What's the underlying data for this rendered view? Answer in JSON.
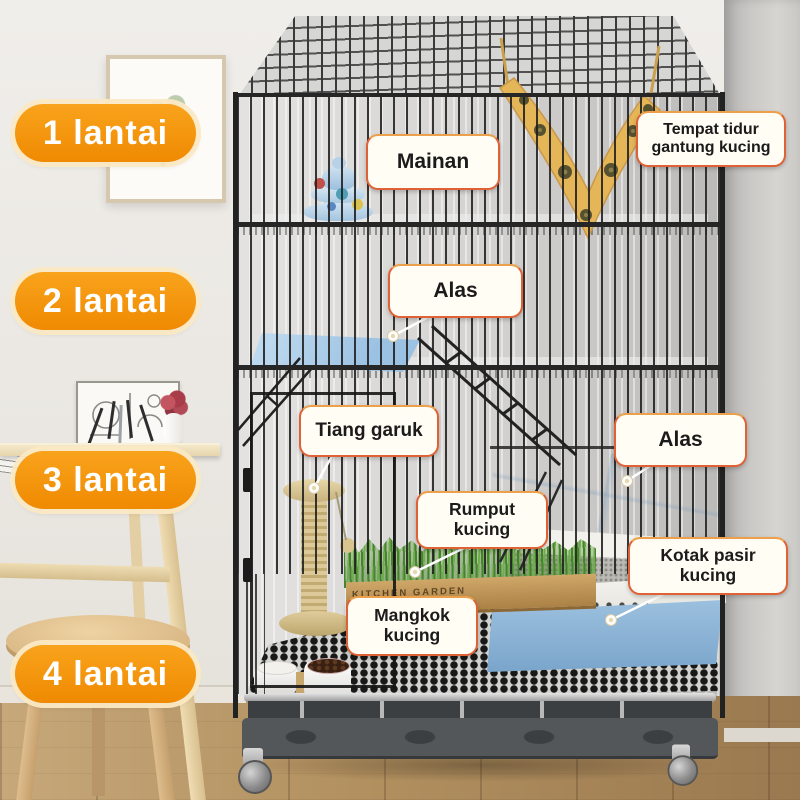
{
  "meta": {
    "title": "Infografik kandang kucing 4 lantai",
    "language": "id",
    "subject": "4-tier wire cat cage with accessories in a room"
  },
  "floor_badges": [
    {
      "id": "floor-1",
      "label": "1 lantai"
    },
    {
      "id": "floor-2",
      "label": "2 lantai"
    },
    {
      "id": "floor-3",
      "label": "3 lantai"
    },
    {
      "id": "floor-4",
      "label": "4 lantai"
    }
  ],
  "item_labels": [
    {
      "id": "mainan",
      "text": "Mainan"
    },
    {
      "id": "tempat-tidur-gantung",
      "text": "Tempat tidur gantung kucing"
    },
    {
      "id": "alas-lantai-2",
      "text": "Alas"
    },
    {
      "id": "tiang-garuk",
      "text": "Tiang garuk"
    },
    {
      "id": "alas-lantai-3",
      "text": "Alas"
    },
    {
      "id": "rumput-kucing",
      "text": "Rumput kucing"
    },
    {
      "id": "kotak-pasir-kucing",
      "text": "Kotak pasir kucing"
    },
    {
      "id": "mangkok-kucing",
      "text": "Mangkok kucing"
    }
  ],
  "scene": {
    "planter_text": "KITCHEN GARDEN",
    "colors": {
      "badge_orange": "#F7930E",
      "badge_ring": "#FBE9C4",
      "label_bg": "#FFFDF4",
      "label_border": "#DF6136",
      "label_text": "#1B1B1B",
      "hammock_yellow": "#E5B658",
      "accessory_blue": "#A7C9E6",
      "litter_box_blue": "#8FB9DA",
      "cage_wire": "#262626",
      "wall": "#EDEAE5",
      "wood_floor": "#B2905F",
      "grass_green": "#5E9A43",
      "post_beige": "#D6C493"
    }
  }
}
